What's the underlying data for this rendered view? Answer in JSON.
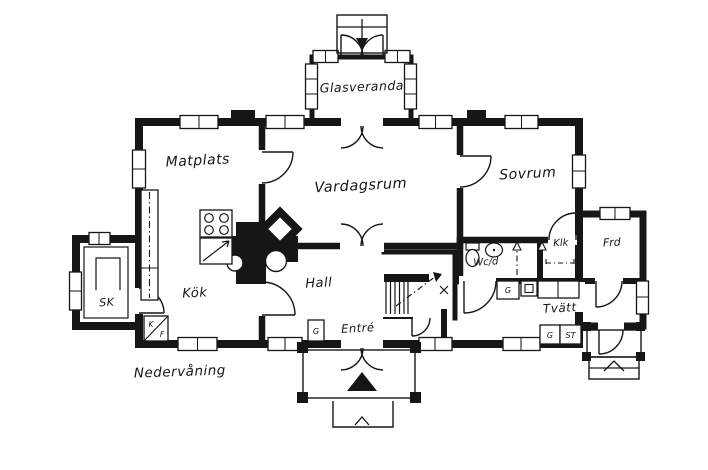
{
  "plan": {
    "floor_label": "Nedervåning",
    "rooms": {
      "glasveranda": "Glasveranda",
      "matplats": "Matplats",
      "vardagsrum": "Vardagsrum",
      "sovrum": "Sovrum",
      "kok": "Kök",
      "sk": "SK",
      "hall": "Hall",
      "entre": "Entré",
      "wcd": "Wc/d",
      "klk": "Klk",
      "frd": "Frd",
      "tvatt": "Tvätt"
    },
    "fixtures": {
      "g": "G",
      "st": "ST",
      "k": "K",
      "f": "F"
    },
    "colors": {
      "line": "#161616",
      "background": "#ffffff"
    }
  }
}
